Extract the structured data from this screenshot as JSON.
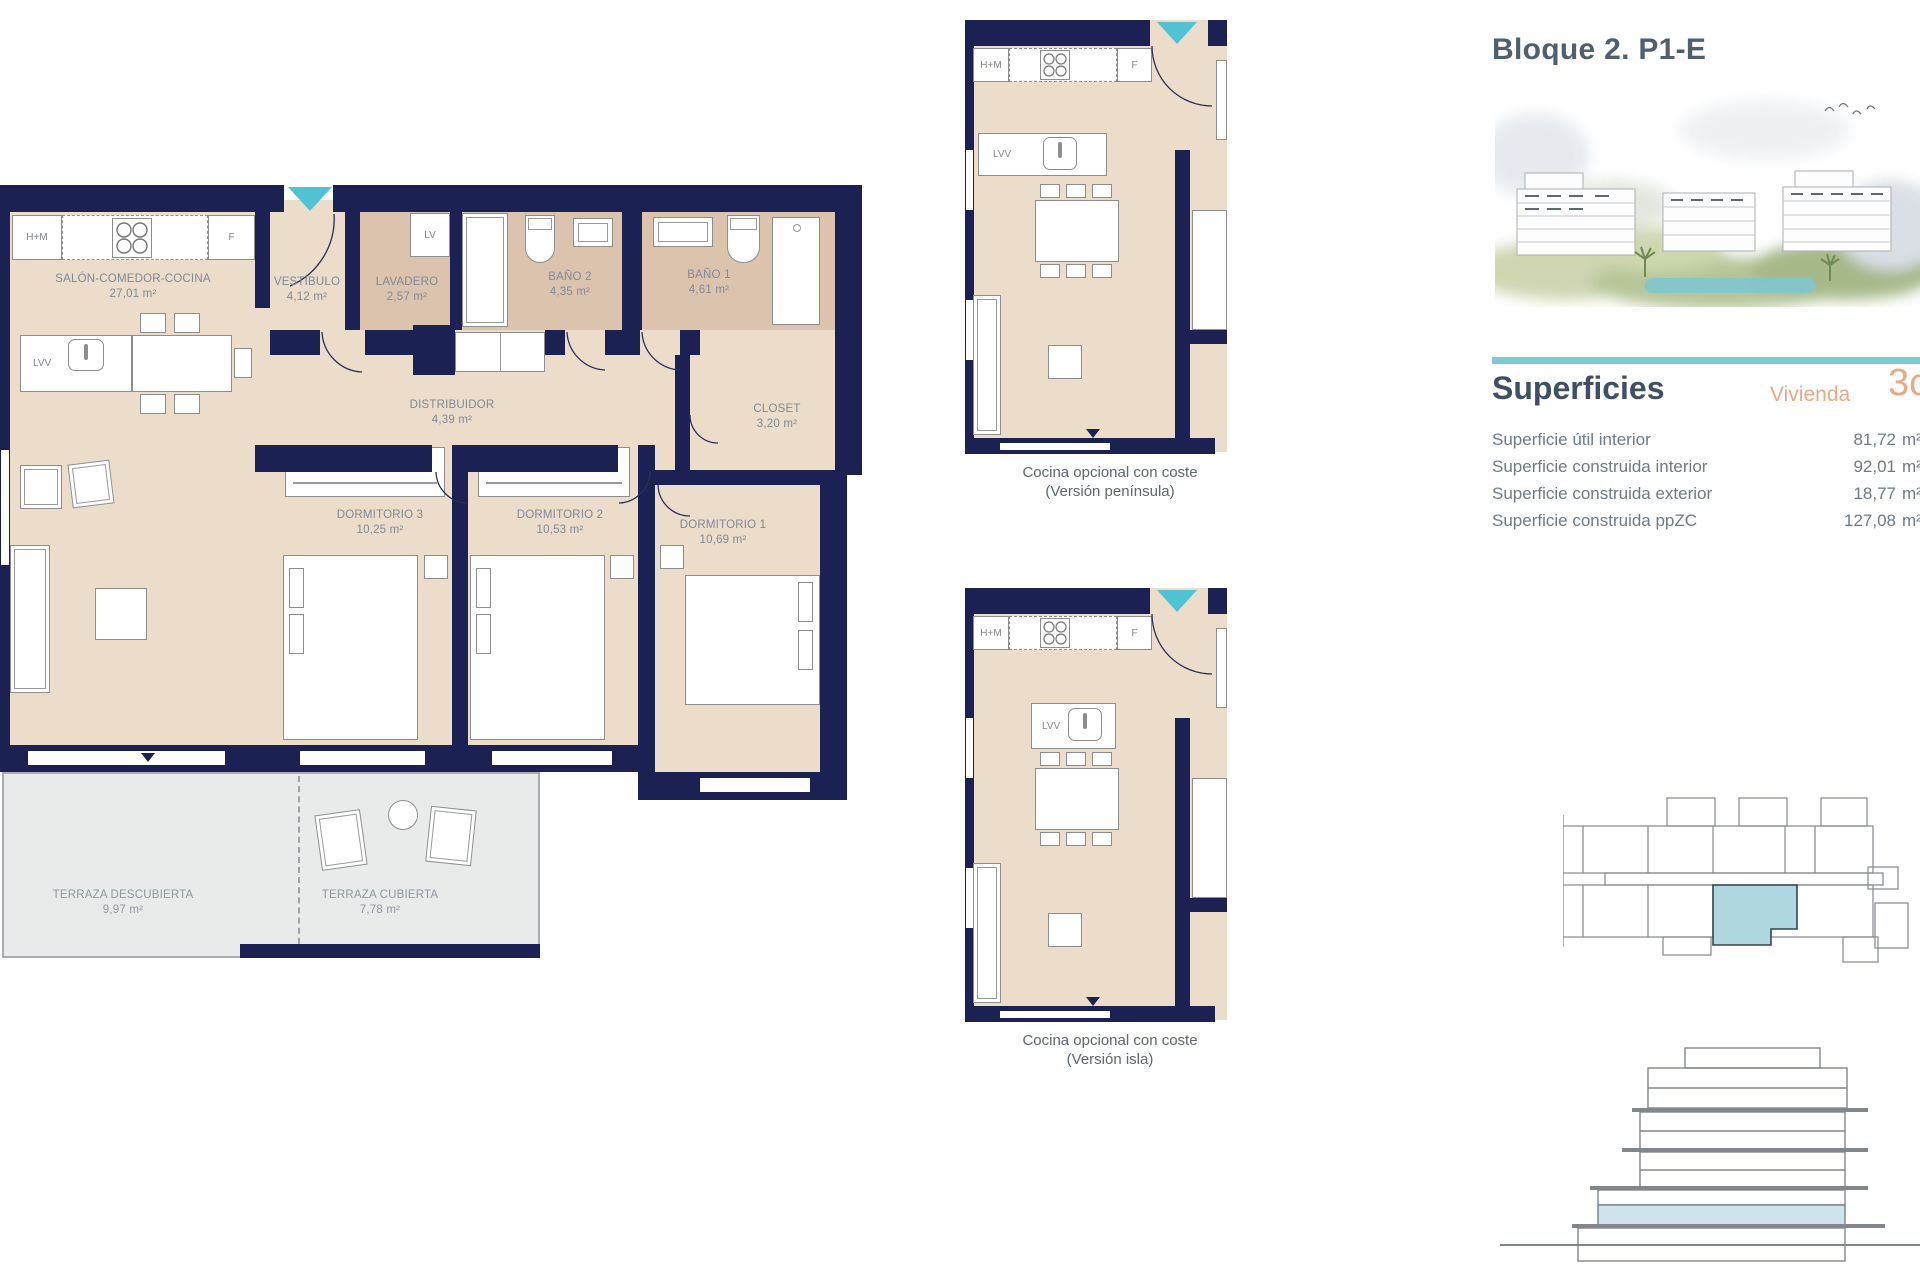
{
  "panel": {
    "title": "Bloque 2. P1-E",
    "superficies_heading": "Superficies",
    "vivienda_label": "Vivienda",
    "vivienda_value": "3c",
    "rows": [
      {
        "label": "Superficie útil interior",
        "value": "81,72",
        "unit": "m²"
      },
      {
        "label": "Superficie construida interior",
        "value": "92,01",
        "unit": "m²"
      },
      {
        "label": "Superficie construida exterior",
        "value": "18,77",
        "unit": "m²"
      },
      {
        "label": "Superficie construida ppZC",
        "value": "127,08",
        "unit": "m²"
      }
    ]
  },
  "main_plan": {
    "rooms": {
      "salon": {
        "name": "SALÓN-COMEDOR-COCINA",
        "area": "27,01 m²"
      },
      "vestibulo": {
        "name": "VESTÍBULO",
        "area": "4,12 m²"
      },
      "lavadero": {
        "name": "LAVADERO",
        "area": "2,57 m²"
      },
      "bano2": {
        "name": "BAÑO 2",
        "area": "4,35 m²"
      },
      "bano1": {
        "name": "BAÑO 1",
        "area": "4,61 m²"
      },
      "distribuidor": {
        "name": "DISTRIBUIDOR",
        "area": "4,39 m²"
      },
      "closet": {
        "name": "CLOSET",
        "area": "3,20 m²"
      },
      "dorm3": {
        "name": "DORMITORIO 3",
        "area": "10,25 m²"
      },
      "dorm2": {
        "name": "DORMITORIO 2",
        "area": "10,53 m²"
      },
      "dorm1": {
        "name": "DORMITORIO 1",
        "area": "10,69 m²"
      },
      "terraza_descubierta": {
        "name": "TERRAZA DESCUBIERTA",
        "area": "9,97 m²"
      },
      "terraza_cubierta": {
        "name": "TERRAZA CUBIERTA",
        "area": "7,78 m²"
      }
    },
    "tags": {
      "hm": "H+M",
      "f": "F",
      "lv": "LV",
      "lvv": "LVV"
    }
  },
  "option_plans": {
    "peninsula": {
      "caption1": "Cocina opcional con coste",
      "caption2": "(Versión península)",
      "hm": "H+M",
      "f": "F",
      "lvv": "LVV"
    },
    "isla": {
      "caption1": "Cocina opcional con coste",
      "caption2": "(Versión isla)",
      "hm": "H+M",
      "f": "F",
      "lvv": "LVV"
    }
  },
  "colors": {
    "wall": "#1b2153",
    "floor": "#ecdcca",
    "wet_floor": "#dcc3ad",
    "terrace": "#e9eaea",
    "entrance_teal": "#4fc3d4",
    "accent_rule": "#7dccd5",
    "heading_blue": "#3f5066",
    "orange": "#eaa983",
    "unit_highlight": "#aed7df",
    "elevation_highlight": "#cfe3ea"
  }
}
